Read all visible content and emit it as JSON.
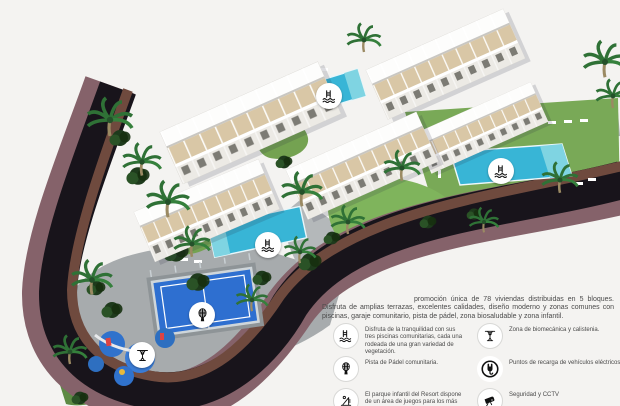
{
  "promo": {
    "paragraph": "promoción única de 78 viviendas distribuidas en 5 bloques. Disfruta de amplias terrazas, excelentes calidades, diseño moderno y zonas comunes con piscinas, garaje comunitario, pista de pádel, zona biosaludable y zona infantil."
  },
  "legend": {
    "items": [
      {
        "icon": "pool-icon",
        "text": "Disfruta de la tranquilidad con sus tres piscinas comunitarias, cada una rodeada de una gran variedad de vegetación."
      },
      {
        "icon": "calisthenics-icon",
        "text": "Zona de biomecánica y calistenia."
      },
      {
        "icon": "padel-icon",
        "text": "Pista de Pádel comunitaria."
      },
      {
        "icon": "ev-charger-icon",
        "text": "Puntos de recarga de vehículos eléctricos"
      },
      {
        "icon": "playground-icon",
        "text": "El parque infantil del Resort dispone de un área de juegos para los más pequeños"
      },
      {
        "icon": "cctv-icon",
        "text": "Seguridad y CCTV"
      }
    ]
  },
  "map_markers": [
    {
      "icon": "pool-icon",
      "area": "piscina norte"
    },
    {
      "icon": "pool-icon",
      "area": "piscina este"
    },
    {
      "icon": "pool-icon",
      "area": "piscina oeste"
    },
    {
      "icon": "padel-icon",
      "area": "pista de pádel"
    },
    {
      "icon": "calisthenics-icon",
      "area": "zona biosaludable"
    }
  ],
  "colors": {
    "background": "#f4f3f1",
    "asphalt": "#18141b",
    "sidewalk": "#85626a",
    "wall": "#6f4a3e",
    "paving": "#a7abad",
    "lawn": "#79a957",
    "pool": "#38b5d6",
    "padel_court": "#2e6fd0",
    "playground": "#3072cc",
    "terrace": "#d9c7a6"
  }
}
